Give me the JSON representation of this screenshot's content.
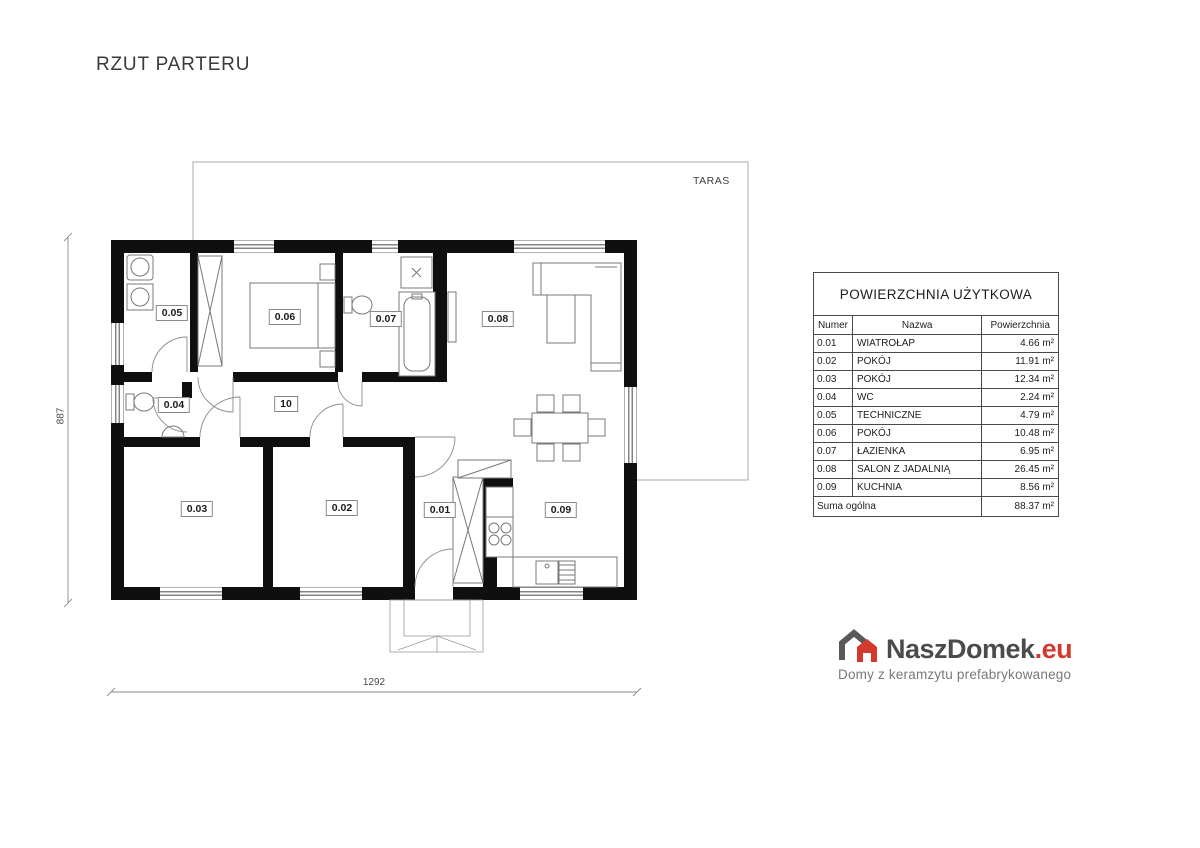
{
  "title": "RZUT PARTERU",
  "plan": {
    "terrace_label": "TARAS",
    "dim_width": "1292",
    "dim_height": "887",
    "room_labels": {
      "r001": "0.01",
      "r002": "0.02",
      "r003": "0.03",
      "r004": "0.04",
      "r005": "0.05",
      "r006": "0.06",
      "r007": "0.07",
      "r008": "0.08",
      "r009": "0.09",
      "hall": "10"
    }
  },
  "table": {
    "title": "POWIERZCHNIA UŻYTKOWA",
    "columns": [
      "Numer",
      "Nazwa",
      "Powierzchnia"
    ],
    "rows": [
      [
        "0.01",
        "WIATROŁAP",
        "4.66 m²"
      ],
      [
        "0.02",
        "POKÓJ",
        "11.91 m²"
      ],
      [
        "0.03",
        "POKÓJ",
        "12.34 m²"
      ],
      [
        "0.04",
        "WC",
        "2.24 m²"
      ],
      [
        "0.05",
        "TECHNICZNE",
        "4.79 m²"
      ],
      [
        "0.06",
        "POKÓJ",
        "10.48 m²"
      ],
      [
        "0.07",
        "ŁAZIENKA",
        "6.95 m²"
      ],
      [
        "0.08",
        "SALON Z JADALNIĄ",
        "26.45 m²"
      ],
      [
        "0.09",
        "KUCHNIA",
        "8.56 m²"
      ]
    ],
    "total_label": "Suma ogólna",
    "total_value": "88.37 m²"
  },
  "logo": {
    "name": "NaszDomek",
    "tld": ".eu",
    "tagline": "Domy z keramzytu prefabrykowanego"
  },
  "colors": {
    "wall": "#0f0f0f",
    "accent_red": "#d23a2e",
    "logo_gray": "#4b4b4d",
    "furniture_line": "#787878",
    "terrace_line": "#b8b8b8"
  }
}
